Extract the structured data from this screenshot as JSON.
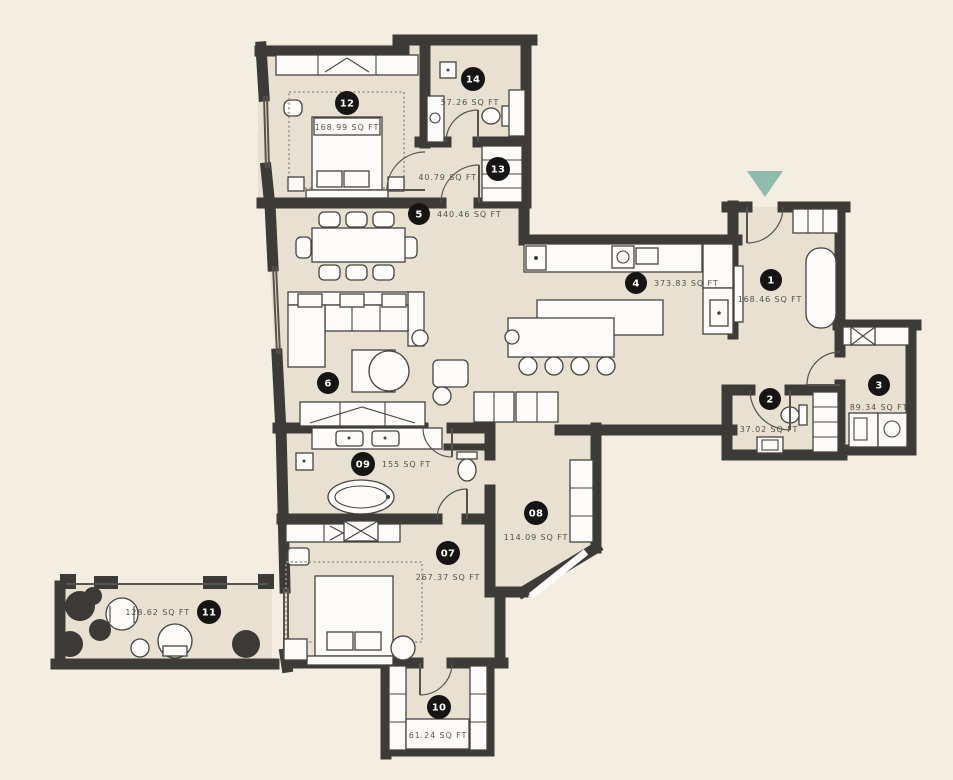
{
  "plan": {
    "colors": {
      "background": "#f3ede2",
      "floor": "#e8e0d1",
      "wall": "#3d3b37",
      "accent_entry_arrow": "#8fbcac",
      "badge": "#161514",
      "label": "#55504b"
    },
    "entry": {
      "marker": "entry-arrow"
    },
    "rooms": [
      {
        "number": "1",
        "area": "168.46 SQ FT"
      },
      {
        "number": "2",
        "area": "37.02 SQ FT"
      },
      {
        "number": "3",
        "area": "89.34 SQ FT"
      },
      {
        "number": "4",
        "area": "373.83 SQ FT"
      },
      {
        "number": "5",
        "area": "440.46 SQ FT"
      },
      {
        "number": "6",
        "area": ""
      },
      {
        "number": "07",
        "area": "267.37 SQ FT"
      },
      {
        "number": "08",
        "area": "114.09 SQ FT"
      },
      {
        "number": "09",
        "area": "155 SQ FT"
      },
      {
        "number": "10",
        "area": "61.24 SQ FT"
      },
      {
        "number": "11",
        "area": "128.62 SQ FT"
      },
      {
        "number": "12",
        "area": "168.99 SQ FT"
      },
      {
        "number": "13",
        "area": "40.79 SQ FT"
      },
      {
        "number": "14",
        "area": "57.26 SQ FT"
      }
    ]
  }
}
